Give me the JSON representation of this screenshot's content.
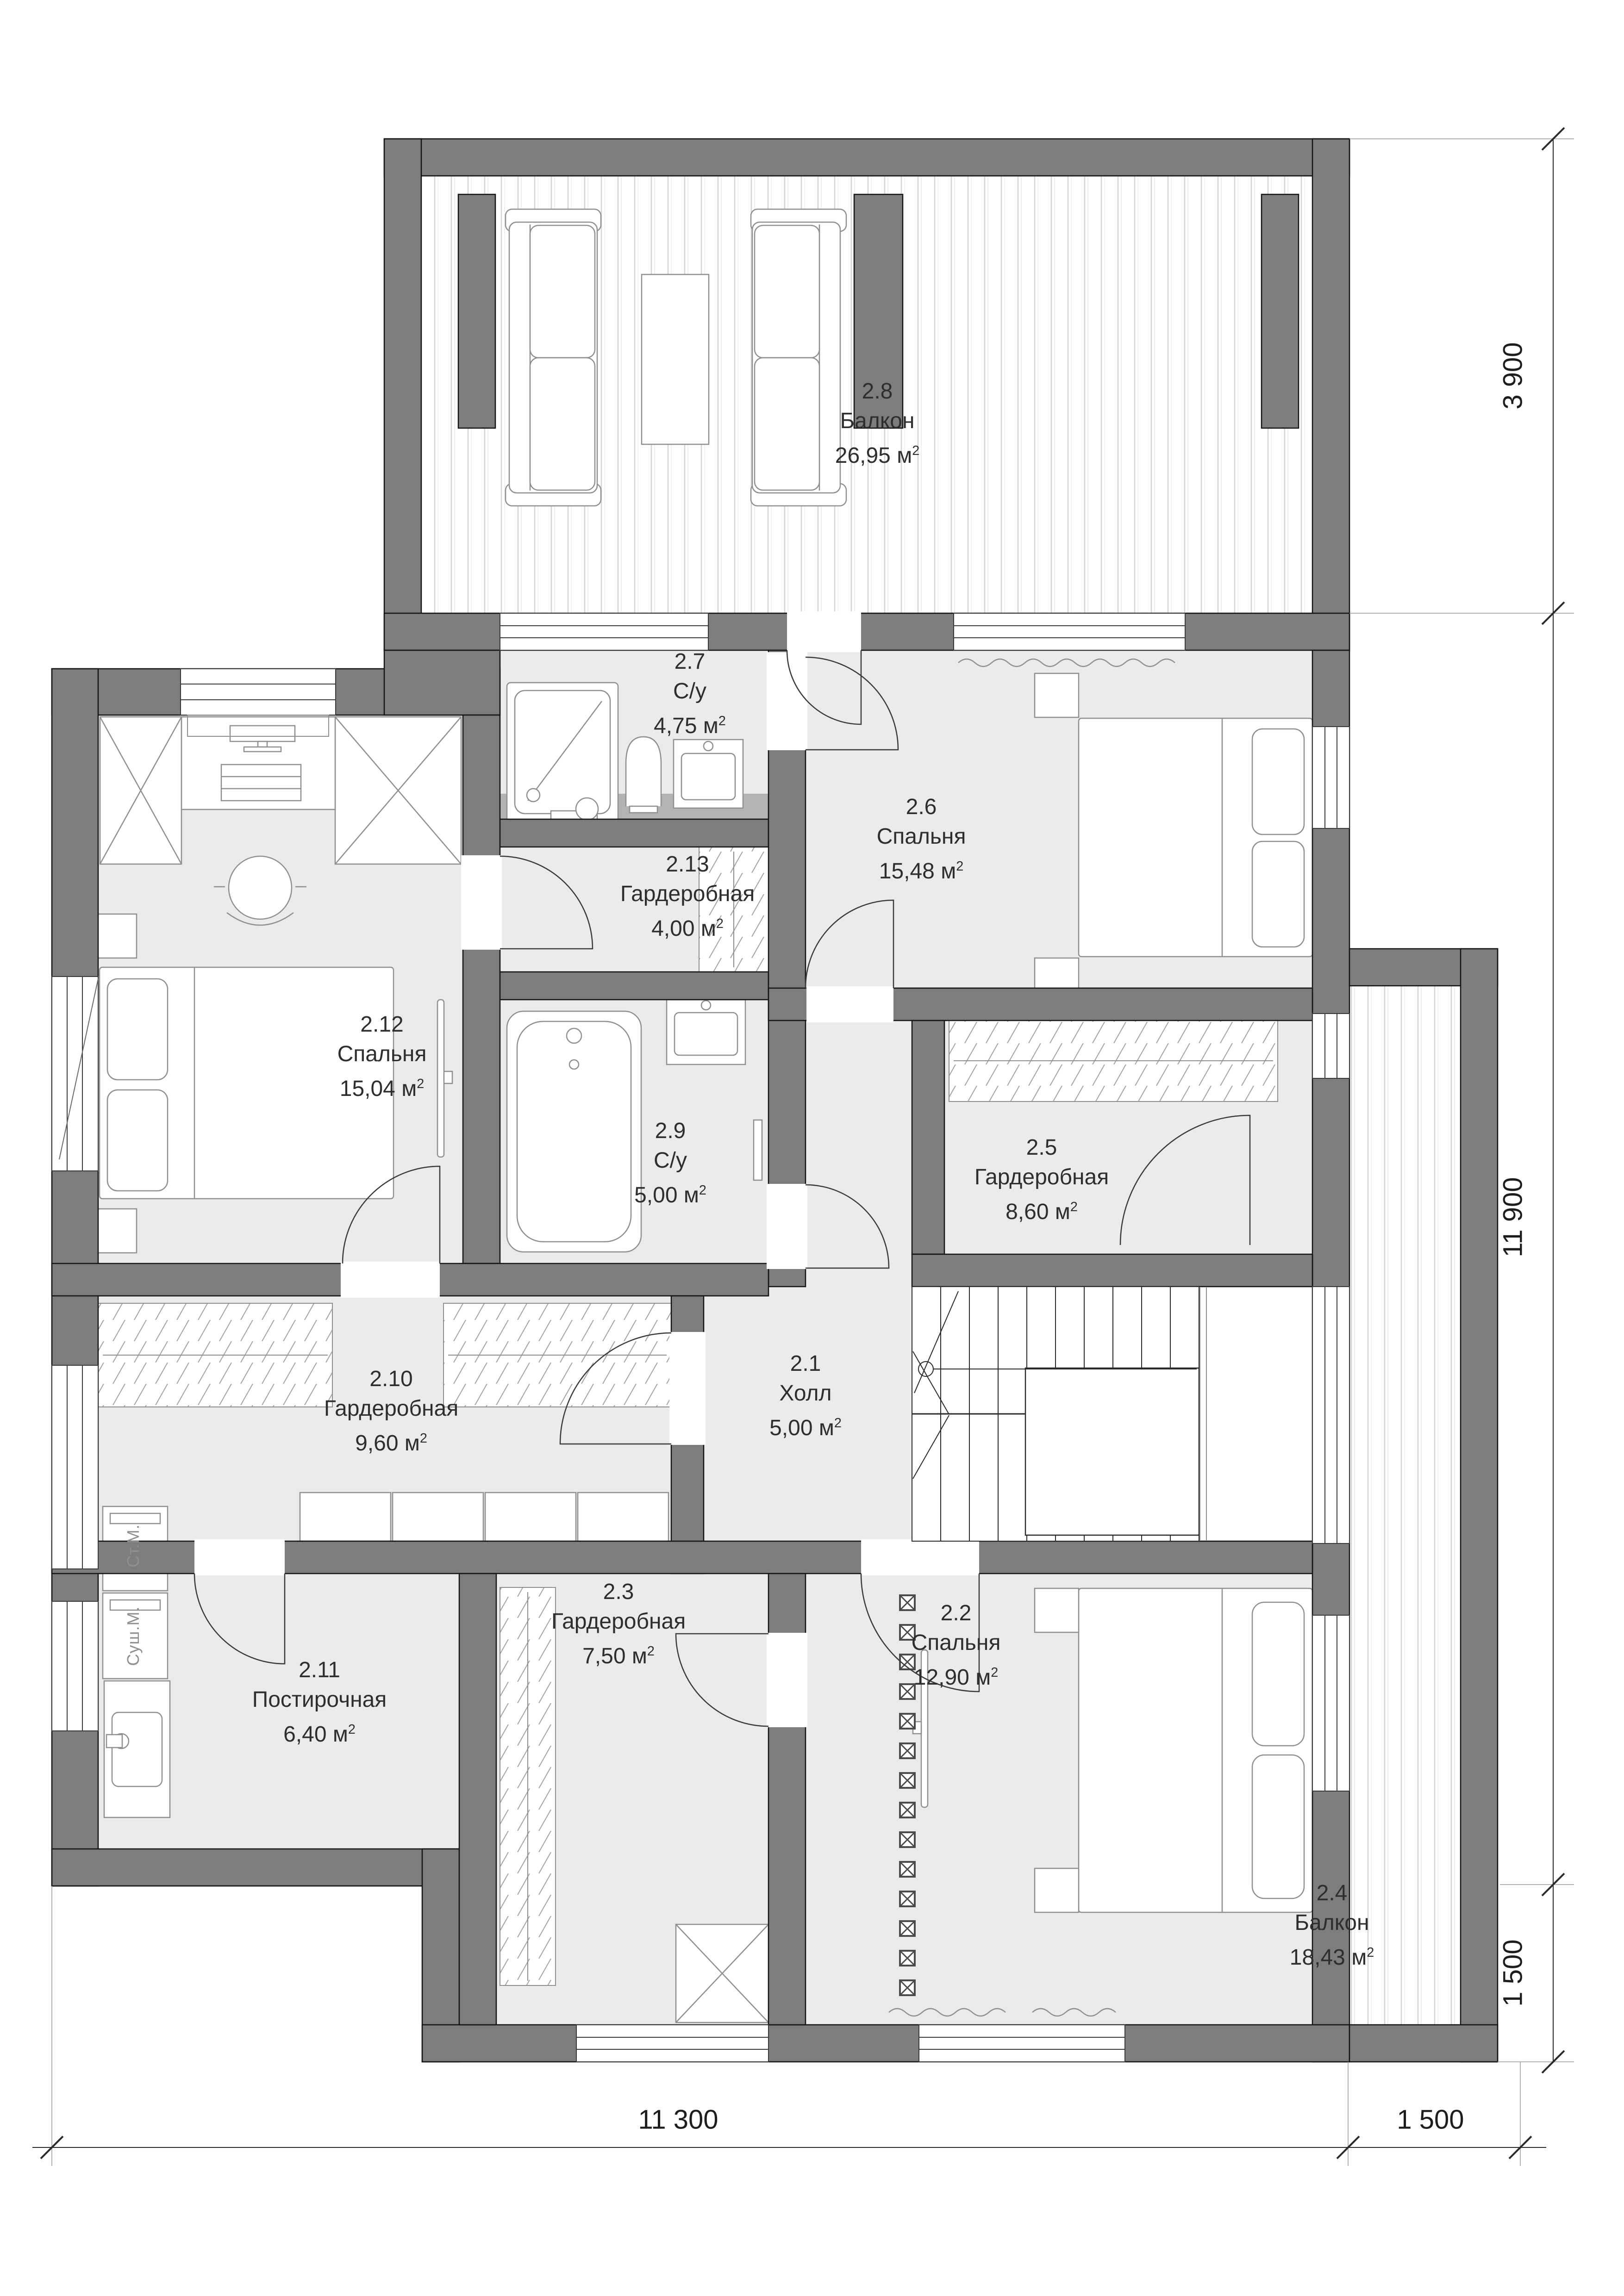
{
  "unit": {
    "base": "м",
    "sup": "2"
  },
  "rooms": [
    {
      "id": "2.8",
      "name": "Балкон",
      "area": "26,95"
    },
    {
      "id": "2.7",
      "name": "С/у",
      "area": "4,75"
    },
    {
      "id": "2.6",
      "name": "Спальня",
      "area": "15,48"
    },
    {
      "id": "2.13",
      "name": "Гардеробная",
      "area": "4,00"
    },
    {
      "id": "2.12",
      "name": "Спальня",
      "area": "15,04"
    },
    {
      "id": "2.9",
      "name": "С/у",
      "area": "5,00"
    },
    {
      "id": "2.5",
      "name": "Гардеробная",
      "area": "8,60"
    },
    {
      "id": "2.10",
      "name": "Гардеробная",
      "area": "9,60"
    },
    {
      "id": "2.1",
      "name": "Холл",
      "area": "5,00"
    },
    {
      "id": "2.11",
      "name": "Постирочная",
      "area": "6,40"
    },
    {
      "id": "2.3",
      "name": "Гардеробная",
      "area": "7,50"
    },
    {
      "id": "2.2",
      "name": "Спальня",
      "area": "12,90"
    },
    {
      "id": "2.4",
      "name": "Балкон",
      "area": "18,43"
    }
  ],
  "appliances": [
    {
      "label": "Ст.М."
    },
    {
      "label": "Суш.М."
    }
  ],
  "dimensions": {
    "right_3900": "3 900",
    "right_11900": "11 900",
    "right_1500": "1 500",
    "bottom_11300": "11 300",
    "bottom_1500": "1 500"
  },
  "colors": {
    "wall": "#7d7d7d",
    "room_fill": "#ebebeb",
    "counter": "#b3b3b3",
    "outline": "#141414",
    "furniture": "#8f8f8f",
    "plank_line": "#d4d4d4",
    "hatch_line": "#a3a3a3",
    "label_text": "#2e2e2e",
    "dim_text": "#1d1d1d",
    "muted_text": "#8f8f8f"
  }
}
